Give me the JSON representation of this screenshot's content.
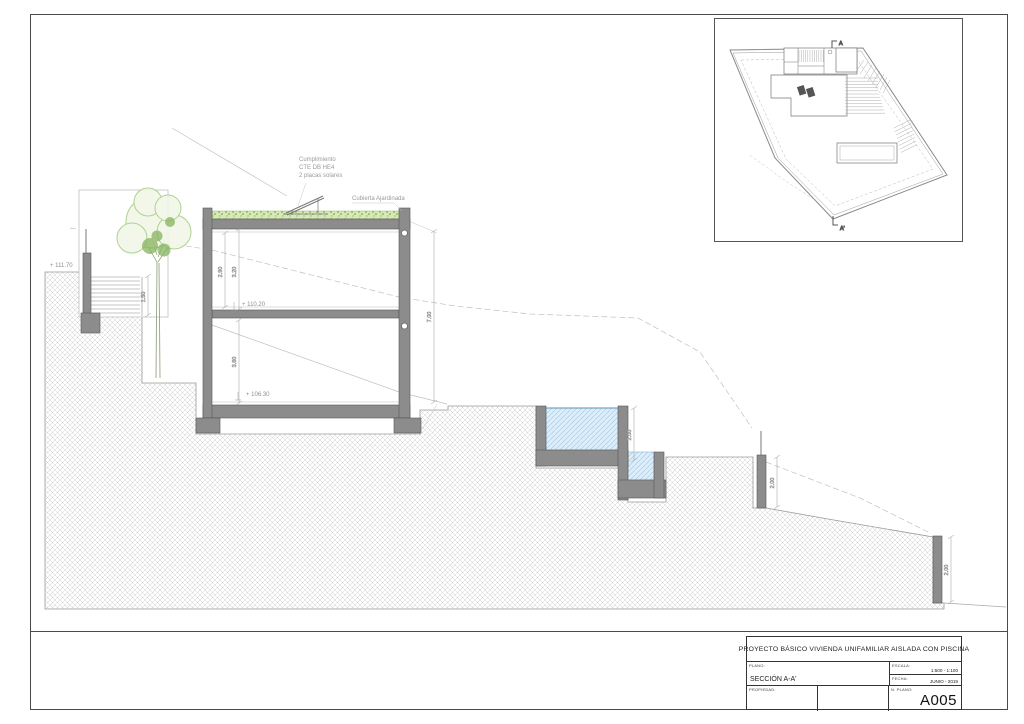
{
  "title_block": {
    "project_title": "PROYECTO BÁSICO VIVIENDA UNIFAMILIAR AISLADA CON PISCINA",
    "fields": {
      "plano_label": "PLANO:",
      "plano_value": "SECCIÓN A-A'",
      "escala_label": "ESCALA:",
      "escala_value": "1:500 - 1:100",
      "fecha_label": "FECHA:",
      "fecha_value": "JUNIO - 2019",
      "propiedad_label": "PROPIEDAD:",
      "num_plano_label": "N. PLANO:",
      "num_plano_value": "A005"
    }
  },
  "section": {
    "levels": {
      "street": "+ 111.70",
      "upper_floor": "+ 110.20",
      "lower_floor": "+ 106.30"
    },
    "annotations": {
      "solar_line1": "Cumplimiento",
      "solar_line2": "CTE DB HE4",
      "solar_line3": "2 placas solares",
      "green_roof": "Cubierta Ajardinada"
    },
    "dimensions": {
      "upper_interior": "2.90",
      "upper_total": "3.20",
      "lower_interior": "3.60",
      "right_total": "7.00",
      "entry_stairs": "1.50",
      "pool_depth": "2.00",
      "mid_retaining_wall": "2.00",
      "lower_retaining_wall": "2.00"
    }
  },
  "site_plan": {
    "section_mark_start": "A",
    "section_mark_end": "A'"
  },
  "colors": {
    "line": "#555555",
    "wall_fill": "#8c8c8c",
    "terrain_hatch": "#cfcfcf",
    "green_roof": "#7fb052",
    "tree": "#a6cd85",
    "pool_water": "#ddeefa",
    "dim_text": "#8f8f8f"
  }
}
